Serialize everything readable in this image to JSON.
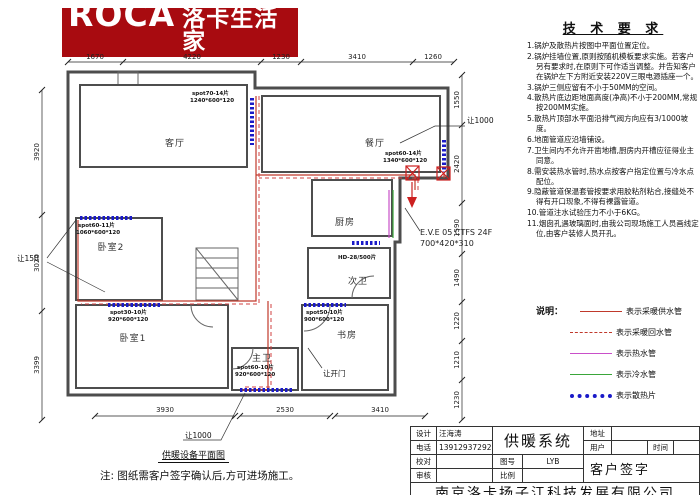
{
  "logo": {
    "brand": "ROCA",
    "brand_cn": "洛卡生活家",
    "tagline1": "欧 洲 品 质",
    "tagline2": "温 润 生 活"
  },
  "tech": {
    "title": "技 术 要 求",
    "items": [
      "1.锅炉及散热片按图中平面位置定位。",
      "2.锅炉挂墙位置,原则按随机模板要求实施。若客户另有要求时,在原则下可作适当调整。并告知客户在锅炉左下方附近安装220V三眼电源插座一个。",
      "3.锅炉三侧应留有不小于50MM的空间。",
      "4.散热片底边距地面高度(净高)不小于200MM,常规按200MM实施。",
      "5.散热片顶部水平面沿排气阀方向应有3/1000坡度。",
      "6.地面管道应沿墙铺设。",
      "7.卫生间内不允许开凿地槽,厨房内开槽应征得业主同意。",
      "8.需安装热水管时,热水点按客户指定位置与冷水点配位。",
      "9.隐蔽管道保温套管按要求用胶粘剂粘合,接缝处不得有开口现象,不得有裸露管道。",
      "10.管道注水试验压力不小于6KG。",
      "11.烟囱孔遇玻璃面时,由我公司现场施工人员画线定位,由客户装修人员开孔。"
    ]
  },
  "legend": {
    "title": "说明：",
    "entries": [
      {
        "label": "表示采暖供水管"
      },
      {
        "label": "表示采暖回水管"
      },
      {
        "label": "表示热水管"
      },
      {
        "label": "表示冷水管"
      },
      {
        "label": "表示散热片"
      }
    ]
  },
  "plan": {
    "rooms": {
      "living": "客厅",
      "dining": "餐厅",
      "kitchen": "厨房",
      "bath2": "次卫",
      "study": "书房",
      "bed2": "卧室2",
      "bed1": "卧室1",
      "bath1": "主卫"
    },
    "radiators": [
      {
        "model": "spot70-14片",
        "size": "1240*600*120"
      },
      {
        "model": "spot60-14片",
        "size": "1340*600*120"
      },
      {
        "model": "spot60-11片",
        "size": "1060*600*120"
      },
      {
        "model": "spot30-10片",
        "size": "920*600*120"
      },
      {
        "model": "spot50-10片",
        "size": "900*600*120"
      },
      {
        "model": "spot60-10片",
        "size": "920*600*120"
      }
    ],
    "bath2_radiator": "HD-28/500片",
    "boiler": {
      "model": "E.V.E 05 CTFS 24F",
      "size": "700*420*310"
    },
    "notes": {
      "top": "让1000",
      "left": "让150",
      "bottom": "让1000",
      "door": "让开门"
    },
    "dims": {
      "top": [
        "1670",
        "4220",
        "1230",
        "3410",
        "1260"
      ],
      "left": [
        "3920",
        "3020",
        "3399"
      ],
      "right": [
        "1550",
        "2420",
        "1590",
        "1490",
        "1220",
        "1210",
        "1230"
      ],
      "bottom": [
        "3930",
        "2530",
        "3410"
      ]
    }
  },
  "plan_caption": {
    "title": "供暖设备平面图",
    "note": "注: 图纸需客户签字确认后,方可进场施工。"
  },
  "titleblock": {
    "labels": {
      "design": "设计",
      "phone": "电话",
      "check": "校对",
      "audit": "审核",
      "drawing_no": "图号",
      "scale": "比例",
      "address": "地址",
      "user": "用户",
      "time": "时间",
      "signature": "客户签字"
    },
    "values": {
      "design": "汪海涛",
      "phone": "13912937292",
      "drawing_no": "LYB",
      "title": "供暖系统"
    },
    "company": "南京洛卡扬子江科技发展有限公司"
  }
}
